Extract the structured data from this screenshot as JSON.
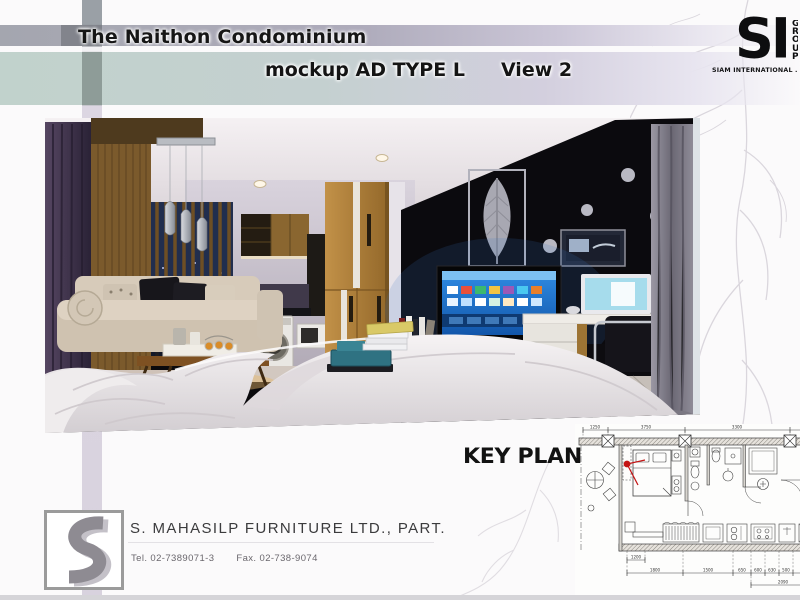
{
  "header": {
    "title": "The Naithon Condominium",
    "mockup_label": "mockup AD TYPE L",
    "view_label": "View 2",
    "band_teal_color": "#c1d2cc",
    "band_gray_color": "#a4a6af"
  },
  "logo": {
    "mark": "SI",
    "side_letters": "GROUP",
    "tagline": "SIAM INTERNATIONAL .CO L"
  },
  "photo": {
    "alt": "Interior rendering of a condominium studio: cream chaise sofa, wood coffee table with tray, pendant lamps, window with wood slats, kitchen with washing machine, golden-oak wardrobe, black feature wall with silver leaf artwork and dots, smart TV on wood media cabinet, desk with monitor and chair, grey curtain, white bed in foreground with teal tray and magazines"
  },
  "key_plan": {
    "label": "KEY PLAN",
    "marker_color": "#c41414",
    "dims_top": [
      "1250",
      "3750",
      "3300"
    ],
    "dim_1200": "1200",
    "dims_bottom": [
      "1800",
      "1500",
      "650",
      "600",
      "630",
      "500"
    ],
    "dim_total": "2090"
  },
  "footer": {
    "company": "S. MAHASILP FURNITURE LTD., PART.",
    "tel": "Tel. 02-7389071-3",
    "fax": "Fax. 02-738-9074"
  }
}
